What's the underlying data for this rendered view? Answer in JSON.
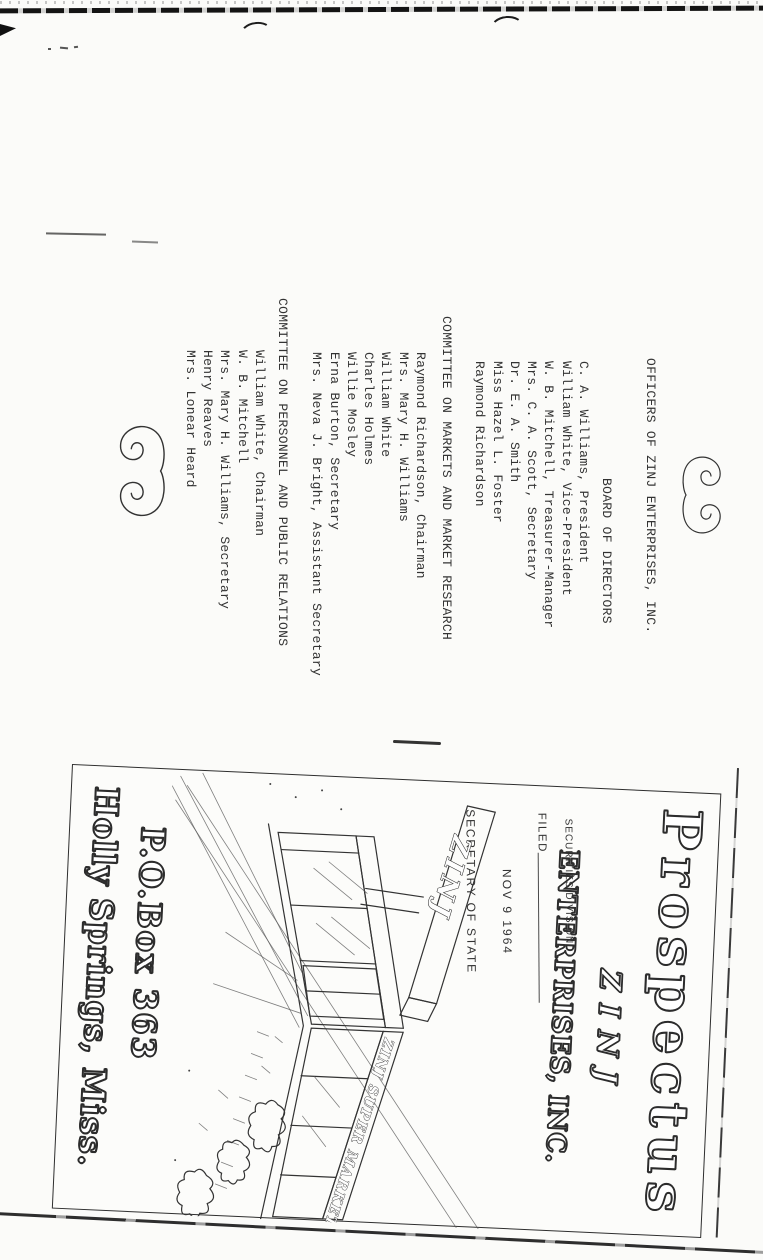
{
  "officers": {
    "title": "OFFICERS OF ZINJ ENTERPRISES, INC.",
    "board": {
      "heading": "BOARD OF DIRECTORS",
      "members": [
        "C. A. Williams, President",
        "William White, Vice-President",
        "W. B. Mitchell, Treasurer-Manager",
        "Mrs. C. A. Scott, Secretary",
        "Dr. E. A. Smith",
        "Miss Hazel L. Foster",
        "Raymond Richardson"
      ]
    },
    "markets_committee": {
      "heading": "COMMITTEE ON MARKETS AND MARKET RESEARCH",
      "members": [
        "Raymond Richardson, Chairman",
        "Mrs. Mary H. Williams",
        "William White",
        "Charles Holmes",
        "Willie Mosley",
        "Erna Burton, Secretary",
        "Mrs. Neva J. Bright, Assistant Secretary"
      ]
    },
    "personnel_committee": {
      "heading": "COMMITTEE ON PERSONNEL AND PUBLIC RELATIONS",
      "members": [
        "William White, Chairman",
        "W. B. Mitchell",
        "Mrs. Mary H. Williams, Secretary",
        "Henry Reaves",
        "Mrs. Lonear Heard"
      ]
    }
  },
  "cover": {
    "title": "Prospectus",
    "company_name": "ZINJ",
    "company_suffix": "ENTERPRISES, INC.",
    "stamp": {
      "division": "SECURITIES DIVISION",
      "status": "FILED",
      "date": "NOV 9 1964",
      "office": "SECRETARY OF STATE"
    },
    "building": {
      "pylon_sign": "ZINJ",
      "fascia_sign": "ZINJ SUPER MARKET"
    },
    "address": {
      "line1": "P.O.Box 363",
      "line2": "Holly Springs, Miss."
    }
  },
  "colors": {
    "ink": "#2b2b2b",
    "paper": "#fbfbf9"
  }
}
